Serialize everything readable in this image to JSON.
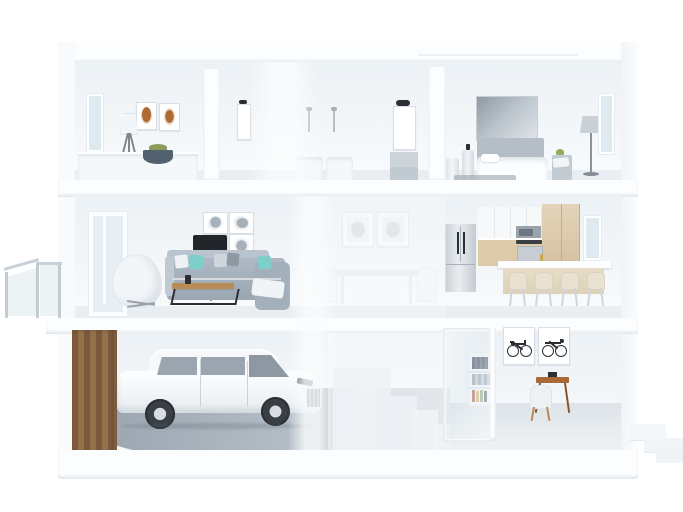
{
  "meta": {
    "title": "3D cutaway dollhouse cross-section of a three-story house"
  },
  "colors": {
    "page-bg": "#ffffff",
    "frame": "#f8fafc",
    "slab": "#fcfdfe",
    "wall-top": "#ecf1f5",
    "wall-bottom": "#f9fbfd",
    "floor-light": "#e9eef2",
    "garage-floor-dark": "#96a1ac",
    "garage-floor-light": "#c8d1d9",
    "office-floor": "#e4e9ee",
    "wood-dark": "#7a593c",
    "wood-light": "#96704b",
    "cabinet-wood": "#ddcba9",
    "island-wood": "#e7ddc8",
    "steel": "#cdd4da",
    "black": "#22252a",
    "sofa": "#a3afbb",
    "sofa-light": "#bac4ce",
    "teal": "#7dd0ca",
    "art-rust": "#b06a33",
    "glass": "#dfe9f0",
    "desk-wood": "#a96a38",
    "coffee-wood": "#b98c55",
    "frame-border": "#d9dfe4",
    "dark-metal": "#2b2f33",
    "headboard": "#b5bec6",
    "lamp-gray": "#c9d0d6",
    "rug": "#99a3ac",
    "book-navy": "#3a4456",
    "book-red": "#a84848",
    "book-yellow": "#c9a84c",
    "book-green": "#7a9a5a",
    "car-body": "#f6f8fa",
    "car-glass": "#9aa5b0"
  },
  "scene": {
    "title": "3D cutaway dollhouse cross-section of a three-story house",
    "floors": [
      {
        "level": "upper",
        "rooms": [
          {
            "name": "Guest bedroom",
            "objects": [
              "side window",
              "two rust-toned framed artworks",
              "white tripod floor lamp",
              "console with dark bowl and greenery"
            ]
          },
          {
            "name": "Bathroom",
            "objects": [
              "small mirror with sconce",
              "two wall faucets",
              "two sinks",
              "mirror with black sconce",
              "gray vanity"
            ]
          },
          {
            "name": "Master bedroom",
            "objects": [
              "large gray wall art",
              "bed with gray headboard",
              "cylinder side tables",
              "gray floor lamp",
              "right window",
              "bench with throw",
              "dark rug"
            ]
          }
        ]
      },
      {
        "level": "main",
        "rooms": [
          {
            "name": "Living room",
            "objects": [
              "tall window",
              "white egg chair",
              "black tripod floor lamp",
              "four botanical prints in 2x2 grid",
              "gray sectional sofa with teal pillows",
              "wood and black-metal coffee table"
            ]
          },
          {
            "name": "Dining area",
            "objects": [
              "two faint prints",
              "dining table",
              "white chairs"
            ]
          },
          {
            "name": "Kitchen",
            "objects": [
              "stainless french-door fridge",
              "white upper cabinets",
              "microwave",
              "cooktop",
              "tall oak cabinets",
              "island with four stools",
              "right window"
            ]
          }
        ]
      },
      {
        "level": "ground",
        "rooms": [
          {
            "name": "Garage",
            "objects": [
              "wood slat wall",
              "white SUV",
              "gray concrete floor"
            ]
          },
          {
            "name": "Staircase",
            "objects": [
              "translucent staircase blocks"
            ]
          },
          {
            "name": "Home office",
            "objects": [
              "glass door",
              "bookshelf with colorful books",
              "two framed bicycle posters",
              "wood desk",
              "white chair"
            ]
          }
        ]
      }
    ],
    "exterior": {
      "left": "glass balcony railing with metal posts",
      "bottom_right": "three white entry steps"
    },
    "counts": {
      "botanical_prints": 4,
      "bar_stools": 4,
      "bicycle_posters": 2,
      "floors": 3
    }
  }
}
